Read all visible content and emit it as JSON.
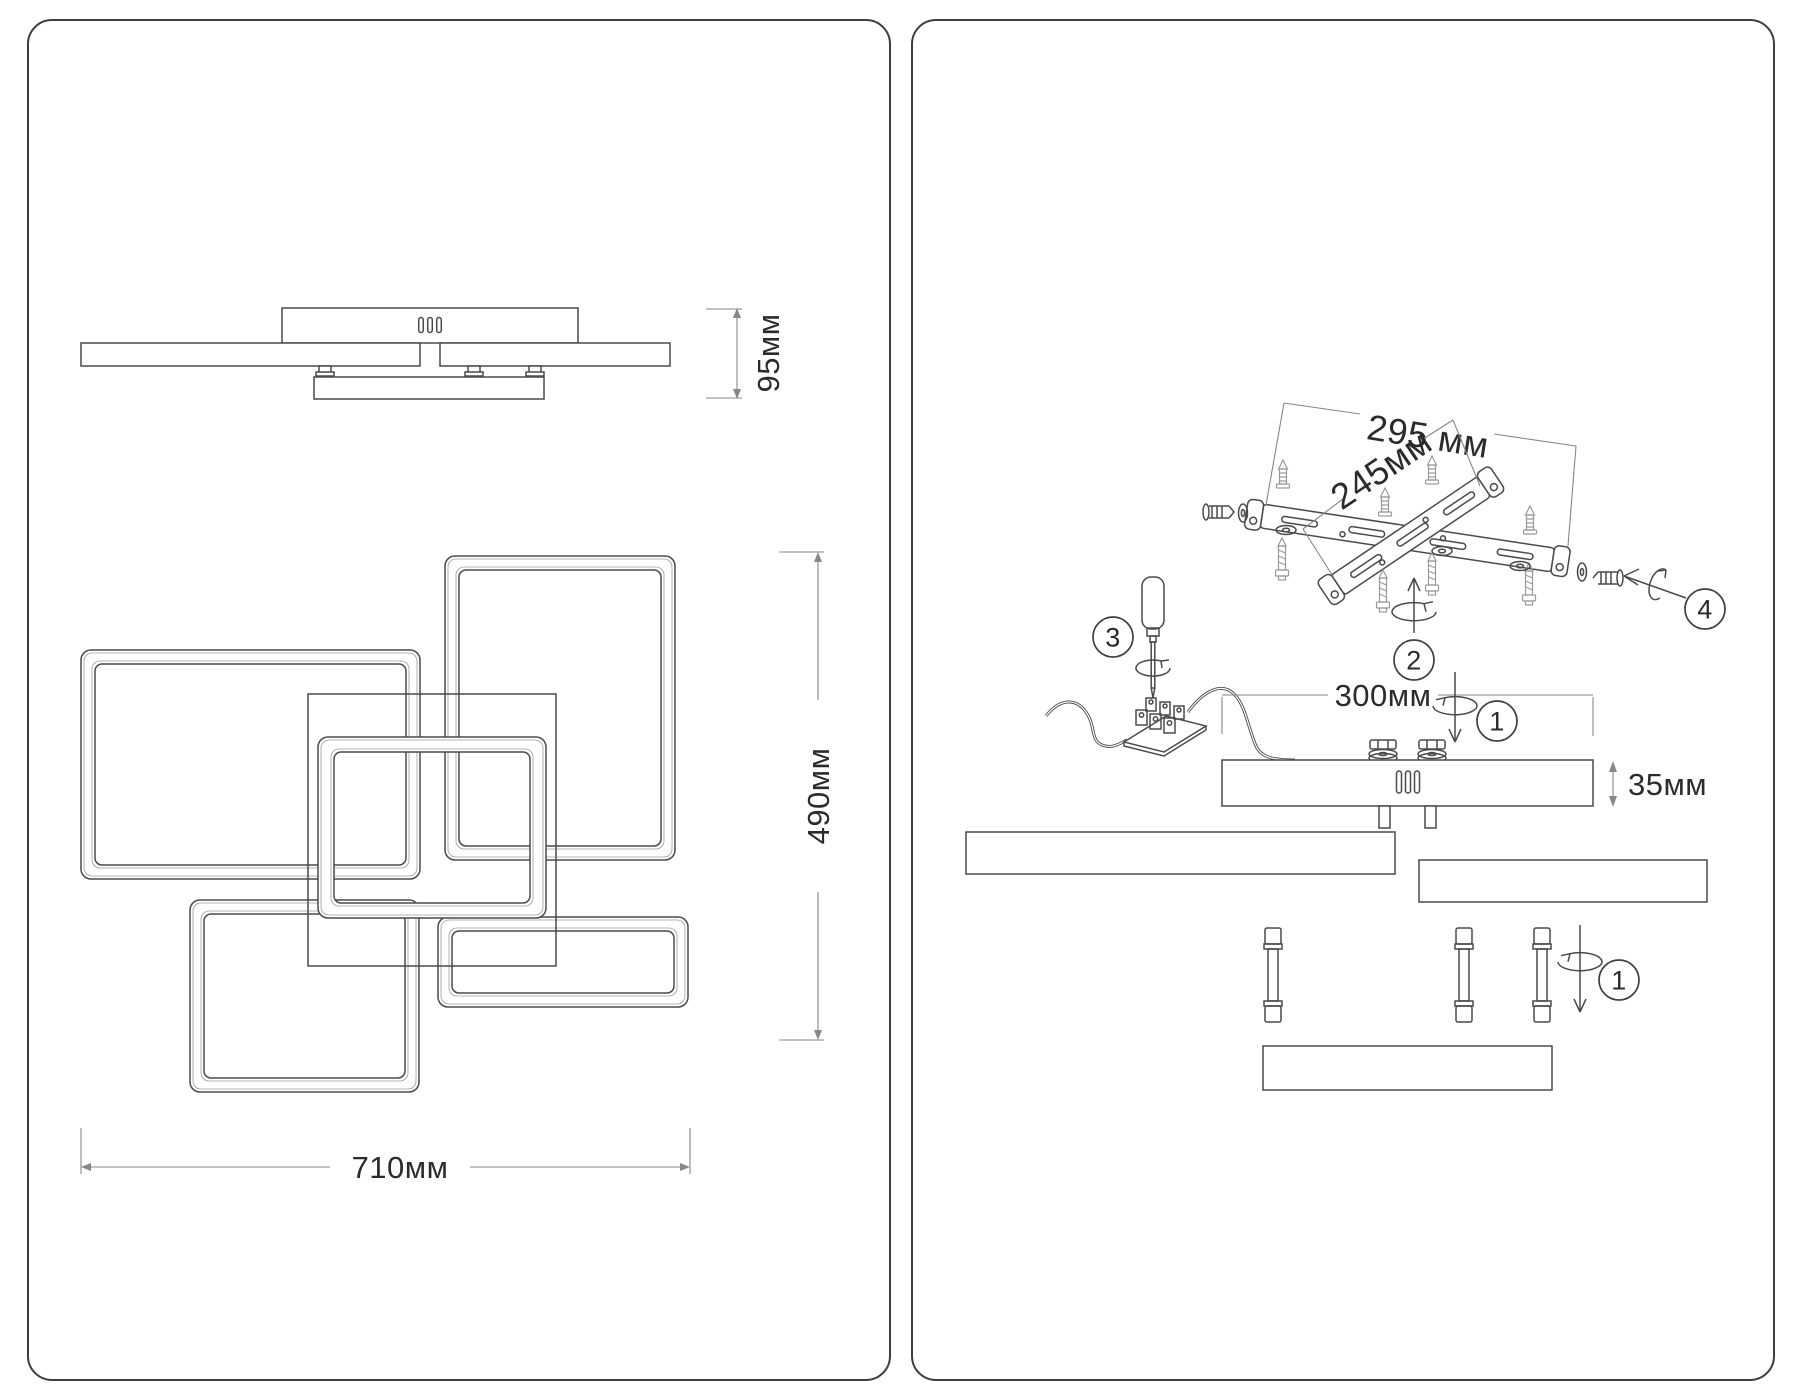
{
  "left_panel": {
    "profile_height_label": "95мм",
    "width_label": "710мм",
    "height_label": "490мм"
  },
  "right_panel": {
    "bracket_length_label": "295 мм",
    "bracket_width_label": "245мм",
    "canopy_width_label": "300мм",
    "canopy_height_label": "35мм",
    "steps": {
      "step1": "1",
      "step2": "2",
      "step3": "3",
      "step4": "4"
    }
  }
}
